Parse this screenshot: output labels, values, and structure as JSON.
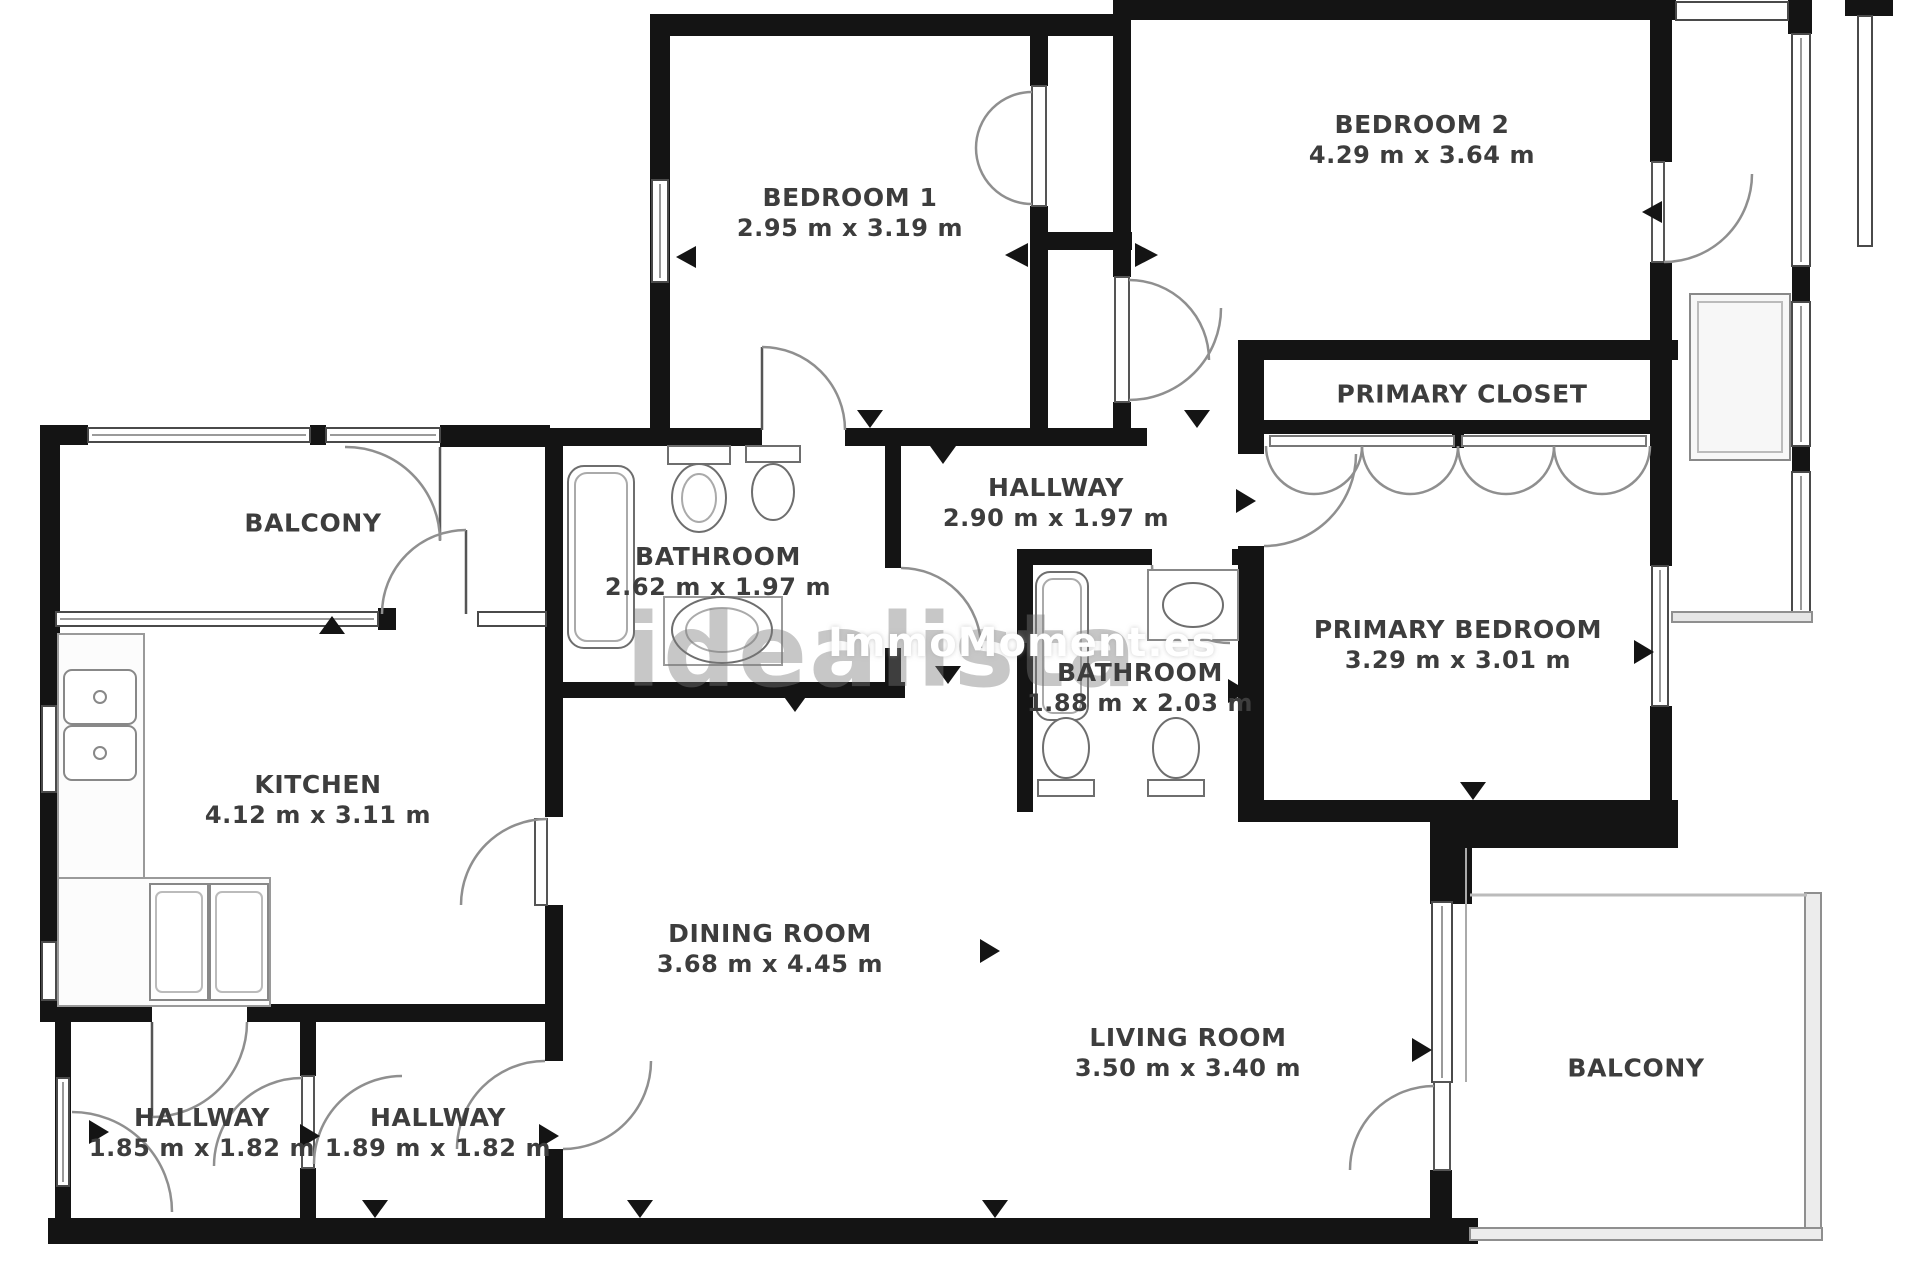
{
  "watermark": {
    "brand": "idealista",
    "agency": "ImmoMoment.es"
  },
  "rooms": {
    "bedroom1": {
      "name": "BEDROOM 1",
      "dims": "2.95 m x 3.19 m"
    },
    "bedroom2": {
      "name": "BEDROOM 2",
      "dims": "4.29 m x 3.64 m"
    },
    "primary_closet": {
      "name": "PRIMARY CLOSET"
    },
    "balcony_top": {
      "name": "BALCONY"
    },
    "bathroom_main": {
      "name": "BATHROOM",
      "dims": "2.62 m x 1.97 m"
    },
    "hallway_center": {
      "name": "HALLWAY",
      "dims": "2.90 m x 1.97 m"
    },
    "bathroom_ensuite": {
      "name": "BATHROOM",
      "dims": "1.88 m x 2.03 m"
    },
    "primary_bedroom": {
      "name": "PRIMARY BEDROOM",
      "dims": "3.29 m x 3.01 m"
    },
    "kitchen": {
      "name": "KITCHEN",
      "dims": "4.12 m x 3.11 m"
    },
    "dining_room": {
      "name": "DINING ROOM",
      "dims": "3.68 m x 4.45 m"
    },
    "living_room": {
      "name": "LIVING ROOM",
      "dims": "3.50 m x 3.40 m"
    },
    "balcony_bottom": {
      "name": "BALCONY"
    },
    "hallway_left": {
      "name": "HALLWAY",
      "dims": "1.85 m x 1.82 m"
    },
    "hallway_right": {
      "name": "HALLWAY",
      "dims": "1.89 m x 1.82 m"
    }
  }
}
